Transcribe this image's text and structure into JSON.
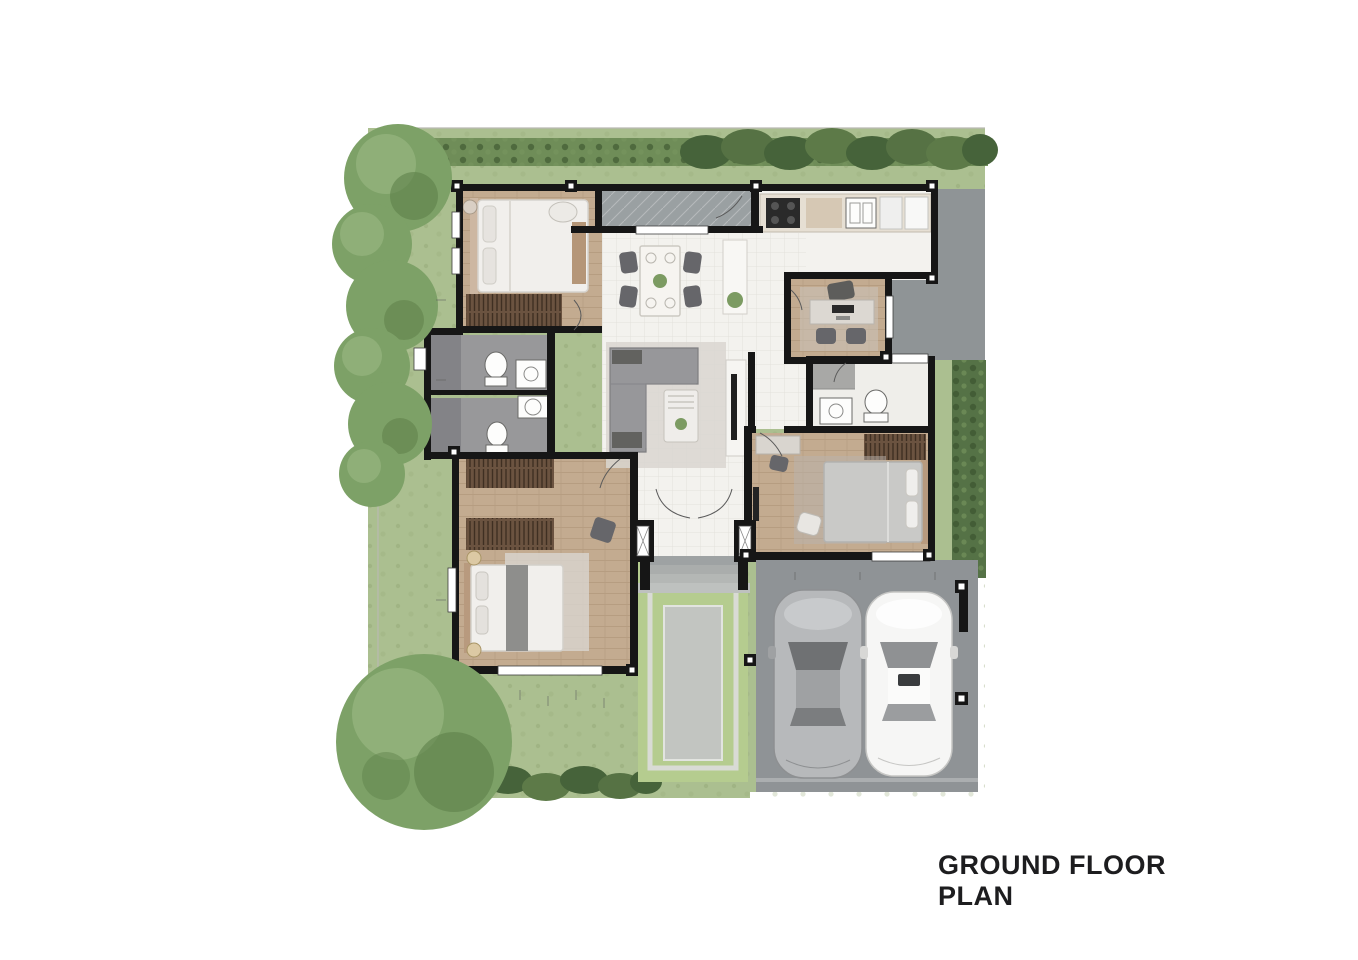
{
  "title": "GROUND FLOOR PLAN",
  "palette": {
    "page_bg": "#ffffff",
    "lawn": "#abbf90",
    "lawn_dark": "#97ad7c",
    "hedge": "#6f8d58",
    "shrub_dark": "#46633a",
    "tree": "#7da167",
    "tree_light": "#93b37d",
    "tree_dark": "#5e8049",
    "wall": "#161616",
    "wood_floor": "#c3ab90",
    "wood_floor_dark": "#b2977b",
    "tile_floor": "#f3f2ee",
    "bath_tile": "#98989a",
    "bath_tile_dark": "#838387",
    "walkway": "#9aa0a2",
    "terrace": "#8f9496",
    "carport": "#8f9396",
    "porch_step": "#b4b7b5",
    "pool_deck": "#b5cc8f",
    "pool_coping": "#d9dbd5",
    "pool_water": "#c2c5c1",
    "wardrobe": "#6b5340",
    "sofa": "#97979a",
    "rug": "#d9d6d0",
    "bed_white": "#f1efec",
    "bed_gray": "#c9c9c7",
    "furniture_dark": "#66666a",
    "car_silver": "#b7b9bb",
    "car_white": "#f6f6f5",
    "title_color": "#1d1d1f"
  },
  "plan": {
    "features": [
      "lawn-garden",
      "perimeter-hedge",
      "left-tree-row",
      "large-corner-tree",
      "bedroom-top-left-with-bed-and-wardrobe",
      "two-bathrooms-left-with-toilet-and-sink",
      "bedroom-bottom-left-with-double-bed-two-wardrobes-rug",
      "open-dining-area-table-4-chairs-plant",
      "living-area-l-sofa-rug-coffee-table-tv-console",
      "kitchen-top-right-counter-stove-sink-fridge",
      "study-room-desk-three-chairs",
      "bathroom-right-with-shower-toilet-sink",
      "bedroom-bottom-right-bed-wardrobe-desk",
      "gray-terrace-walkway",
      "entry-porch-steps-double-door",
      "lap-pool-with-green-deck",
      "carport-with-two-cars"
    ],
    "vehicles": [
      {
        "name": "silver-car"
      },
      {
        "name": "white-car"
      }
    ]
  }
}
